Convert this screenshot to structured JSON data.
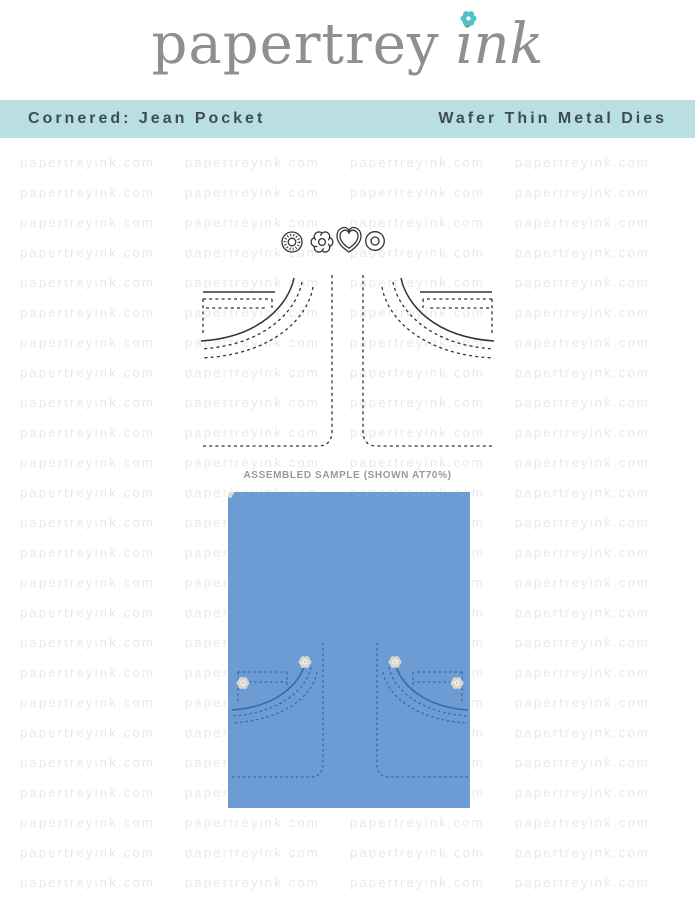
{
  "logo": {
    "brand": "papertrey",
    "suffix": "ink"
  },
  "banner": {
    "product_name": "Cornered: Jean Pocket",
    "product_type": "Wafer Thin Metal Dies"
  },
  "watermark": {
    "text": "papertreyink.com"
  },
  "sample": {
    "label": "ASSEMBLED SAMPLE (SHOWN AT70%)"
  },
  "figure": {
    "embellishments": [
      "jean-button-die",
      "flower-die",
      "heart-die",
      "rivet-die"
    ],
    "pockets": [
      "left-jean-pocket-die",
      "right-jean-pocket-die"
    ]
  },
  "colors": {
    "banner_bg": "#b9dfe1",
    "banner_text": "#3e4c55",
    "logo_gray": "#8f8f8f",
    "accent_teal": "#4ec3c5",
    "card_blue": "#6d9bd3",
    "stitch_blue": "#3a68ae",
    "die_line": "#333333",
    "watermark_gray": "#e9e9e9",
    "label_gray": "#999999",
    "rivet_silver": "#d9d8cf"
  }
}
